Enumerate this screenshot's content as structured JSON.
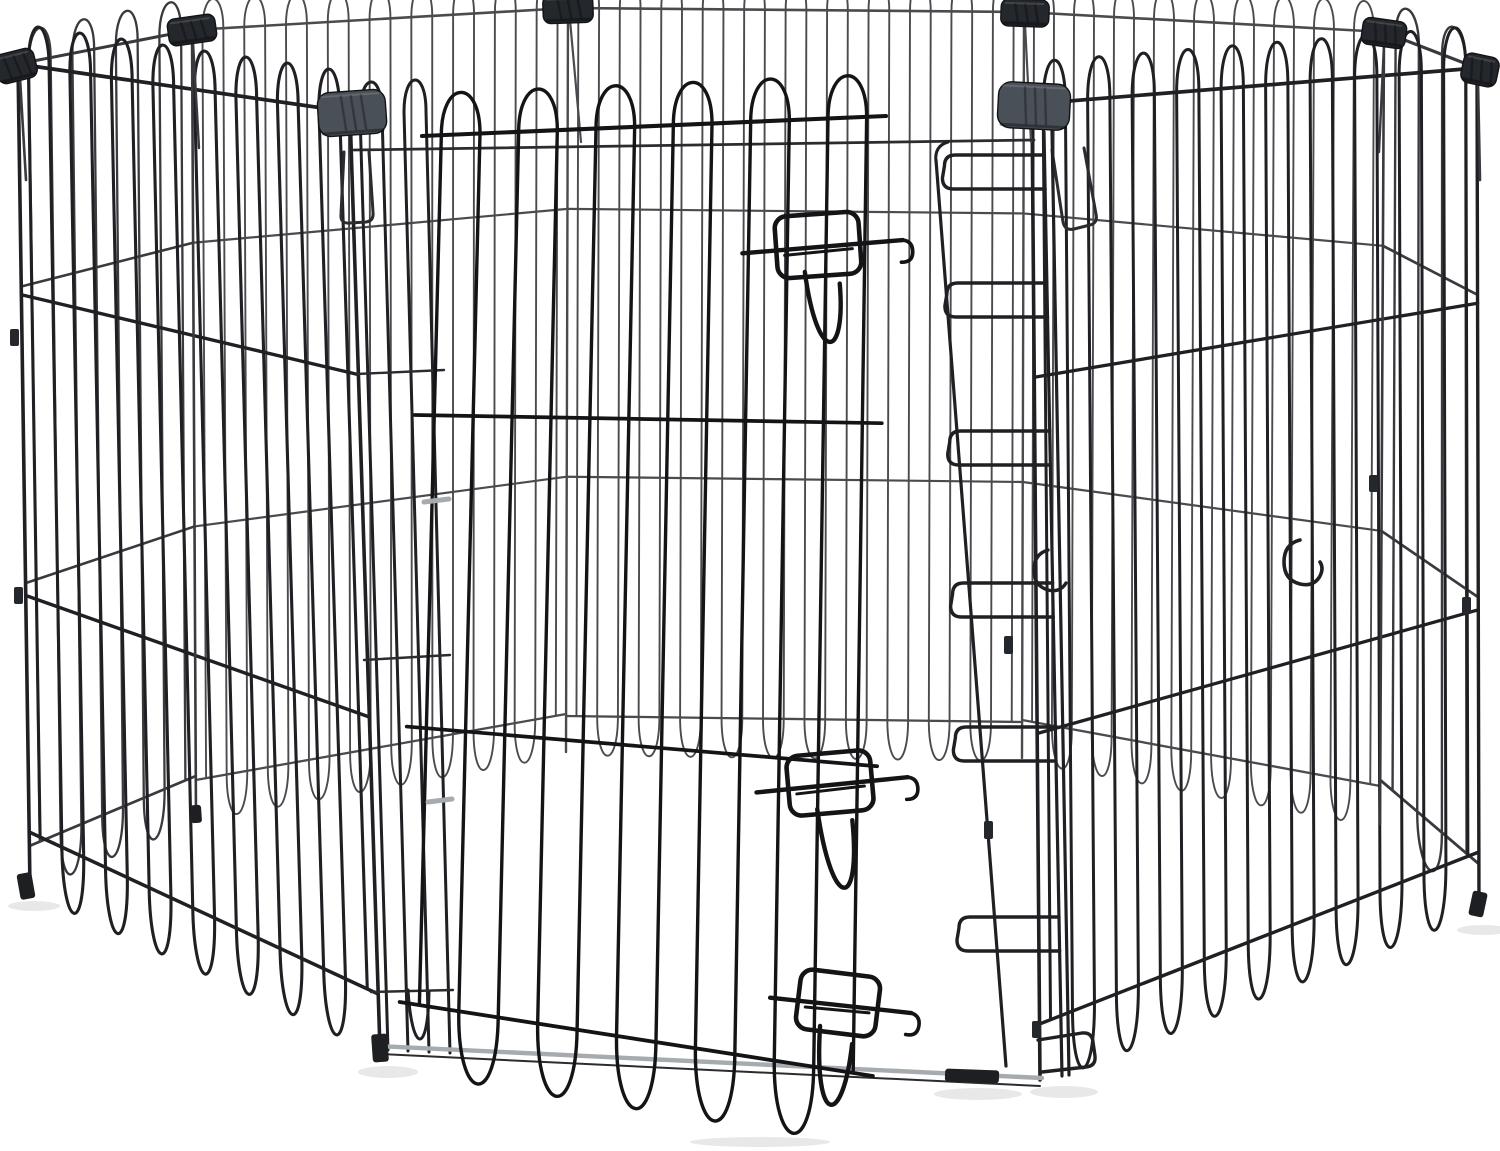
{
  "image": {
    "description": "Product photo: octagonal black foldable metal wire pet exercise pen (8 mesh panels) with a wire door, three slide-bolt latches, dark plastic corner clips and a ladder-style latch receiver, on a plain white background",
    "background": "#ffffff"
  },
  "palette": {
    "wire_door": "#141417",
    "wire_front": "#202024",
    "wire_mid": "#2c2c30",
    "wire_side": "#3a3a3e",
    "wire_back": "#4b4b4f",
    "wire_light": "#a6abb0",
    "clip_dark": "#24272b",
    "clip_gray": "#4a5057",
    "foot": "#1d1f22",
    "shadow": "rgba(0,0,0,0.09)"
  },
  "pen": {
    "shadows": [
      [
        34,
        906,
        26,
        5
      ],
      [
        388,
        1072,
        30,
        6
      ],
      [
        978,
        1094,
        44,
        6
      ],
      [
        1064,
        1092,
        34,
        6
      ],
      [
        1483,
        930,
        26,
        5
      ],
      [
        760,
        1142,
        70,
        5
      ]
    ],
    "panels": [
      {
        "id": "back-center",
        "tl": [
          568,
          8
        ],
        "tr": [
          1024,
          12
        ],
        "br": [
          1022,
          758
        ],
        "bl": [
          566,
          752
        ],
        "wires": 22,
        "stroke": 1.9,
        "color": "wire_back",
        "rails": [
          0.27,
          0.63
        ],
        "loop_t": 30,
        "loop_b": 36
      },
      {
        "id": "back-left",
        "tl": [
          192,
          30
        ],
        "tr": [
          568,
          8
        ],
        "br": [
          566,
          752
        ],
        "bl": [
          196,
          818
        ],
        "wires": 18,
        "stroke": 1.9,
        "color": "wire_back",
        "rails": [
          0.27,
          0.63
        ],
        "loop_t": 30,
        "loop_b": 38
      },
      {
        "id": "back-right",
        "tl": [
          1024,
          12
        ],
        "tr": [
          1384,
          32
        ],
        "br": [
          1380,
          824
        ],
        "bl": [
          1022,
          758
        ],
        "wires": 18,
        "stroke": 1.9,
        "color": "wire_back",
        "rails": [
          0.27,
          0.63
        ],
        "loop_t": 30,
        "loop_b": 38
      },
      {
        "id": "side-left",
        "tl": [
          18,
          64
        ],
        "tr": [
          192,
          30
        ],
        "br": [
          196,
          818
        ],
        "bl": [
          30,
          888
        ],
        "wires": 8,
        "stroke": 2.3,
        "color": "wire_side",
        "rails": [
          0.27,
          0.63
        ],
        "loop_t": 32,
        "loop_b": 42
      },
      {
        "id": "side-right",
        "tl": [
          1384,
          32
        ],
        "tr": [
          1477,
          68
        ],
        "br": [
          1479,
          908
        ],
        "bl": [
          1380,
          824
        ],
        "wires": 4,
        "stroke": 2.4,
        "color": "wire_side",
        "rails": [
          0.27,
          0.63
        ],
        "loop_t": 32,
        "loop_b": 44
      },
      {
        "id": "front-right",
        "tl": [
          1032,
          104
        ],
        "tr": [
          1477,
          68
        ],
        "br": [
          1479,
          908
        ],
        "bl": [
          1040,
          1080
        ],
        "wires": 20,
        "stroke": 3.0,
        "color": "wire_front",
        "rails": [
          0.28,
          0.645
        ],
        "loop_t": 42,
        "loop_b": 56
      },
      {
        "id": "front-left",
        "tl": [
          18,
          64
        ],
        "tr": [
          350,
          112
        ],
        "br": [
          380,
          1050
        ],
        "bl": [
          30,
          888
        ],
        "wires": 16,
        "stroke": 3.1,
        "color": "wire_front",
        "rails": [
          0.28,
          0.645
        ],
        "loop_t": 40,
        "loop_b": 56
      }
    ],
    "junctions": [
      [
        18,
        64,
        30,
        888,
        3.6,
        "wire_front"
      ],
      [
        192,
        30,
        196,
        818,
        2.6,
        "wire_side"
      ],
      [
        568,
        8,
        566,
        752,
        2.4,
        "wire_back"
      ],
      [
        1024,
        12,
        1022,
        758,
        2.4,
        "wire_back"
      ],
      [
        1384,
        32,
        1380,
        824,
        2.6,
        "wire_side"
      ],
      [
        1477,
        68,
        1479,
        908,
        3.4,
        "wire_front"
      ],
      [
        350,
        112,
        380,
        1050,
        3.6,
        "wire_front"
      ],
      [
        1032,
        104,
        1040,
        1080,
        3.6,
        "wire_front"
      ]
    ],
    "extras_mid": {
      "lines": [
        [
          193,
          42,
          199,
          148,
          2.4,
          "wire_side"
        ],
        [
          570,
          20,
          581,
          142,
          2.2,
          "wire_back"
        ],
        [
          1025,
          24,
          1031,
          142,
          2.2,
          "wire_back"
        ],
        [
          1384,
          44,
          1379,
          152,
          2.4,
          "wire_side"
        ],
        [
          20,
          78,
          26,
          180,
          2.6,
          "wire_side"
        ],
        [
          1478,
          82,
          1480,
          180,
          2.6,
          "wire_side"
        ],
        [
          354,
          150,
          1034,
          140,
          2.8,
          "wire_mid"
        ],
        [
          360,
          114,
          388,
          1050,
          3,
          "wire_front"
        ],
        [
          382,
          113,
          408,
          1051,
          3,
          "wire_front"
        ],
        [
          404,
          112,
          429,
          1052,
          3,
          "wire_front"
        ],
        [
          426,
          111,
          450,
          1053,
          3,
          "wire_front"
        ],
        [
          357,
          374,
          444,
          370,
          2.4,
          "wire_mid"
        ],
        [
          364,
          660,
          450,
          655,
          2.4,
          "wire_mid"
        ],
        [
          371,
          992,
          453,
          990,
          2.4,
          "wire_mid"
        ],
        [
          378,
          1046,
          1042,
          1078,
          4.4,
          "wire_light"
        ],
        [
          380,
          1054,
          1040,
          1086,
          2,
          "wire_mid"
        ]
      ],
      "paths": [
        [
          "M 360,114 C 360,72 382,71 382,113",
          3,
          "wire_front"
        ],
        [
          "M 404,112 C 404,70 426,69 426,111",
          3,
          "wire_front"
        ],
        [
          "M 408,990 C 412,1054 428,1056 429,992",
          3,
          "wire_front"
        ],
        [
          "M 344,152 L 341,214 Q 340,224 350,223 L 366,222 Q 374,221 373,212 L 369,152",
          3,
          "wire_mid"
        ],
        [
          "M 1052,150 L 1063,222 Q 1065,231 1074,229 L 1090,225 Q 1098,223 1096,214 L 1084,148",
          3,
          "wire_mid"
        ]
      ]
    },
    "receiver": {
      "v1": [
        936,
        160,
        1006,
        1066
      ],
      "v2": [
        1044,
        132,
        1062,
        1076
      ],
      "v2b": [
        1052,
        131,
        1069,
        1075
      ],
      "stroke": 3.2,
      "rung_y": [
        172,
        300,
        448,
        600,
        744,
        934
      ],
      "rung_w": 100,
      "clips": [
        [
          1008,
          645
        ],
        [
          988,
          830
        ]
      ],
      "top_curl": "M 936,162 q -2,-16 12,-20"
    },
    "door": {
      "id": "door",
      "tl": [
        422,
        136
      ],
      "tr": [
        886,
        116
      ],
      "br": [
        872,
        1140
      ],
      "bl": [
        398,
        1066
      ],
      "wires": 12,
      "stroke": 3.4,
      "color": "wire_door",
      "rails": [
        0.3,
        0.635
      ],
      "loop_t": 42,
      "loop_b": 64
    },
    "latches": [
      {
        "id": "latch-top",
        "cx": 818,
        "cy": 245,
        "w": 84,
        "h": 62,
        "rot": -4,
        "bar_l": -76,
        "bar_r": 85,
        "u_len": 78
      },
      {
        "id": "latch-middle",
        "cx": 830,
        "cy": 783,
        "w": 84,
        "h": 60,
        "rot": -5,
        "bar_l": -74,
        "bar_r": 78,
        "u_len": 90
      },
      {
        "id": "latch-bottom",
        "cx": 838,
        "cy": 1003,
        "w": 80,
        "h": 60,
        "rot": 7,
        "bar_l": -68,
        "bar_r": 74,
        "u_len": 85
      }
    ],
    "extras_front": {
      "lines": [
        [
          424,
          502,
          449,
          499,
          5,
          "wire_light"
        ],
        [
          428,
          802,
          452,
          799,
          5,
          "wire_light"
        ]
      ],
      "paths": [
        [
          "M 1300,540 q -16,4 -16,22 q 0,18 16,22 q 14,3 20,-8 q 4,-8 0,-14",
          3.6,
          "wire_front"
        ],
        [
          "M 1048,550 q -14,4 -14,20 q 0,16 14,20 q 12,3 18,-7",
          3.4,
          "wire_front"
        ],
        [
          "M 1038,1040 L 1082,1033 Q 1092,1032 1093,1042 L 1095,1056 Q 1096,1066 1086,1067 L 1042,1072",
          3.4,
          "wire_front"
        ]
      ]
    },
    "clips": [
      {
        "id": "corner-clip-back-left",
        "x": 192,
        "y": 30,
        "w": 48,
        "h": 27,
        "rot": -8,
        "fill": "clip_dark"
      },
      {
        "id": "corner-clip-back-center-left",
        "x": 568,
        "y": 9,
        "w": 50,
        "h": 28,
        "rot": -2,
        "fill": "clip_dark"
      },
      {
        "id": "corner-clip-back-center-right",
        "x": 1025,
        "y": 13,
        "w": 48,
        "h": 27,
        "rot": 2,
        "fill": "clip_dark"
      },
      {
        "id": "corner-clip-back-right",
        "x": 1384,
        "y": 33,
        "w": 44,
        "h": 27,
        "rot": 8,
        "fill": "clip_dark"
      },
      {
        "id": "corner-clip-left-edge",
        "x": 16,
        "y": 66,
        "w": 40,
        "h": 30,
        "rot": -14,
        "fill": "clip_dark"
      },
      {
        "id": "corner-clip-right-edge",
        "x": 1480,
        "y": 70,
        "w": 36,
        "h": 30,
        "rot": 12,
        "fill": "clip_dark"
      },
      {
        "id": "corner-clip-front-left",
        "x": 352,
        "y": 113,
        "w": 68,
        "h": 44,
        "rot": -4,
        "fill": "clip_gray"
      },
      {
        "id": "corner-clip-front-right",
        "x": 1034,
        "y": 106,
        "w": 72,
        "h": 46,
        "rot": 3,
        "fill": "clip_gray"
      }
    ],
    "edge_clips": [
      [
        14,
        338
      ],
      [
        18,
        596
      ],
      [
        1373,
        484
      ],
      [
        1466,
        606
      ],
      [
        1036,
        1030
      ]
    ],
    "feet": [
      {
        "x": 26,
        "y": 886,
        "w": 15,
        "h": 26,
        "rot": -10
      },
      {
        "x": 196,
        "y": 814,
        "w": 11,
        "h": 18,
        "rot": -4
      },
      {
        "x": 380,
        "y": 1048,
        "w": 16,
        "h": 28,
        "rot": -4
      },
      {
        "x": 972,
        "y": 1076,
        "w": 54,
        "h": 13,
        "rot": 2
      },
      {
        "x": 1478,
        "y": 904,
        "w": 15,
        "h": 25,
        "rot": 12
      }
    ]
  }
}
